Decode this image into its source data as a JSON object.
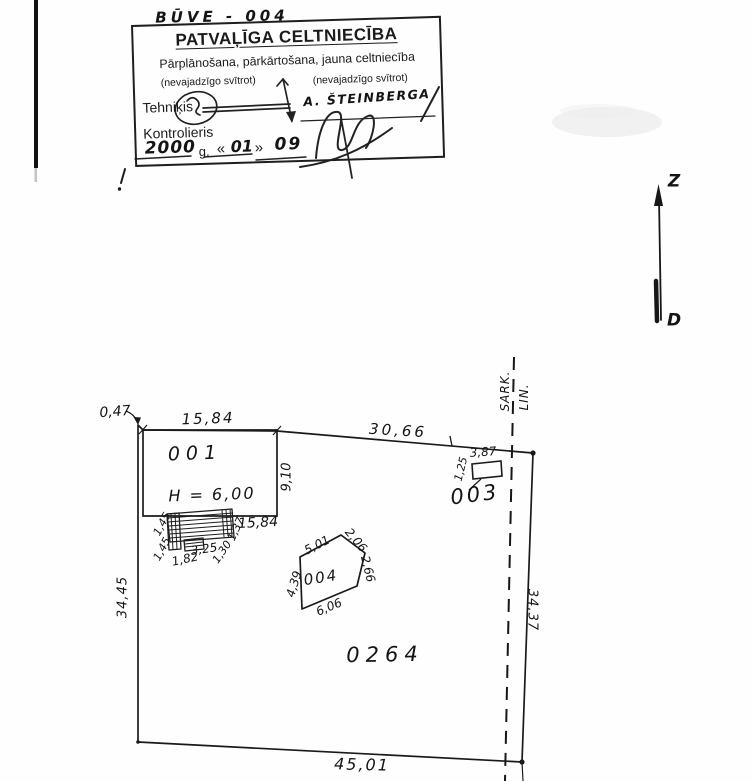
{
  "page": {
    "doc_ref": "BŪVE - 004"
  },
  "stamp": {
    "title": "PATVAĻĪGA CELTNIECĪBA",
    "line2": "Pārplānošana, pārkārtošana, jauna celtniecība",
    "note_left": "(nevajadzīgo svītrot)",
    "note_right": "(nevajadzīgo svītrot)",
    "tehnikis_label": "Tehniķis",
    "kontrolieris_label": "Kontrolieris",
    "signed_name": "A. ŠTEINBERGA",
    "date": {
      "year": "2000",
      "g": "g.",
      "open": "«",
      "month": "01",
      "close": "»",
      "day": "09"
    }
  },
  "compass": {
    "north": "Z",
    "south": "D"
  },
  "plan": {
    "parcel_number": "0264",
    "red_line": {
      "word1": "SARK.",
      "word2": "LIN."
    },
    "building_001": {
      "label": "001",
      "height": "H = 6,00"
    },
    "building_003": {
      "label": "003"
    },
    "building_004": {
      "label": "004"
    },
    "dims": {
      "offset_left": "0,47",
      "b001_top": "15,84",
      "b001_bottom": "15,84",
      "b001_side": "9,10",
      "top_right": "30,66",
      "left": "34,45",
      "right": "34,37",
      "bottom": "45,01",
      "b003_w": "3,87",
      "b003_h": "1,25",
      "porch_1": "1,45",
      "porch_2": "1,45",
      "porch_3": "1,82",
      "porch_4": "3,25",
      "porch_5": "1,30",
      "porch_6": "1,37",
      "b004_top": "5,01",
      "b004_ne": "2,06",
      "b004_right": "2,66",
      "b004_bottom": "6,06",
      "b004_left": "4,39"
    }
  }
}
